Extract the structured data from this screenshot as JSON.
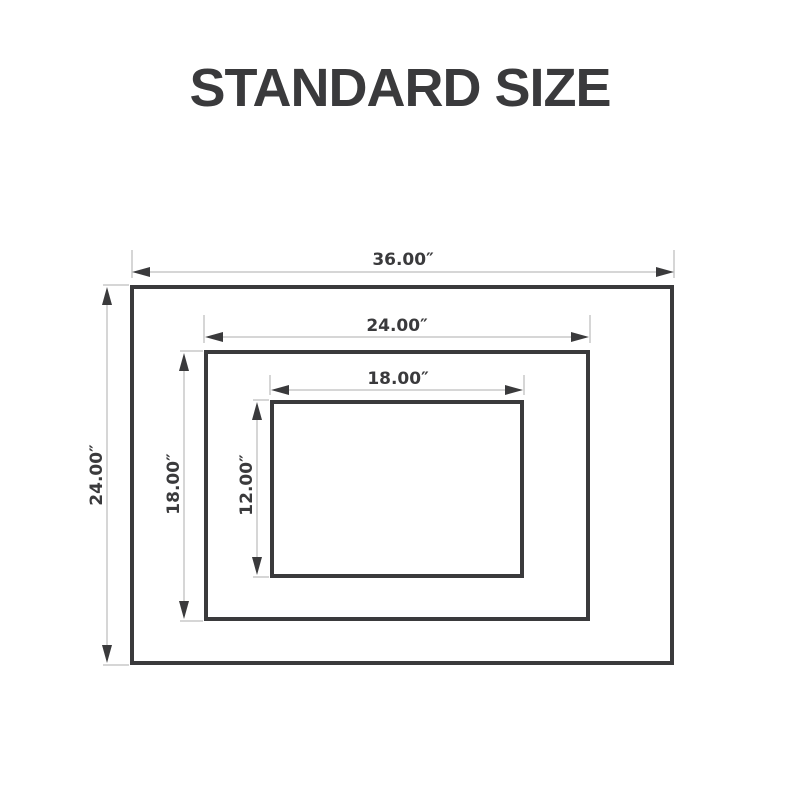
{
  "title": "STANDARD SIZE",
  "colors": {
    "ink": "#3a3a3c",
    "dim_line": "#c9c9c9",
    "background": "#ffffff"
  },
  "sizes": [
    {
      "name": "outer",
      "width": "36.00″",
      "height": "24.00″"
    },
    {
      "name": "middle",
      "width": "24.00″",
      "height": "18.00″"
    },
    {
      "name": "inner",
      "width": "18.00″",
      "height": "12.00″"
    }
  ]
}
